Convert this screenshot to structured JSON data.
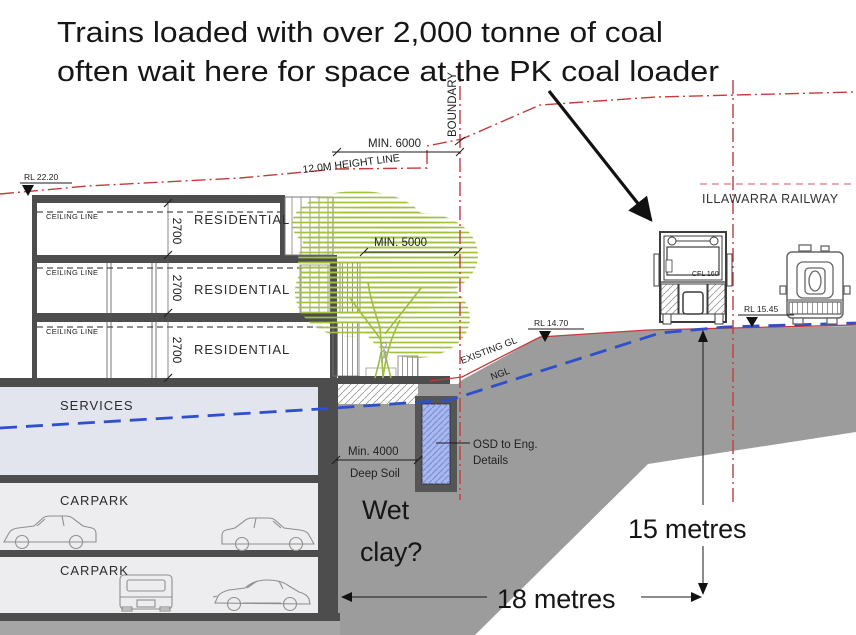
{
  "title": {
    "line1": "Trains loaded with over 2,000 tonne of coal",
    "line2": "often wait here for space at the PK coal loader"
  },
  "labels": {
    "boundary": "BOUNDARY",
    "min_6000": "MIN. 6000",
    "height_line": "12.0M HEIGHT LINE",
    "min_5000": "MIN. 5000",
    "rl_2220": "RL 22.20",
    "rl_1470": "RL 14.70",
    "rl_1545": "RL 15.45",
    "ceiling_line": "CEILING LINE",
    "residential": "RESIDENTIAL",
    "dim_2700": "2700",
    "services": "SERVICES",
    "carpark": "CARPARK",
    "illawarra_railway": "ILLAWARRA RAILWAY",
    "existing_gl": "EXISTING GL",
    "ngl": "NGL",
    "min_4000": "Min. 4000",
    "deep_soil": "Deep Soil",
    "osd_line1": "OSD to Eng.",
    "osd_line2": "Details",
    "wet_clay_line1": "Wet",
    "wet_clay_line2": "clay?",
    "fifteen_metres": "15 metres",
    "eighteen_metres": "18 metres",
    "loco_model": "CFL 160"
  },
  "colors": {
    "red_line": "#c43b3b",
    "blue_ngl": "#2f50c8",
    "ground_gray": "#9c9c9c",
    "ground_gray2": "#a6a6a6",
    "slab_dark": "#4d4d4d",
    "services_fill": "#e2e4ee",
    "carpark_fill": "#ededef",
    "osd_blue": "#a9b8ee",
    "tree_green": "#a3c13f",
    "ink": "#1a1a1a"
  }
}
